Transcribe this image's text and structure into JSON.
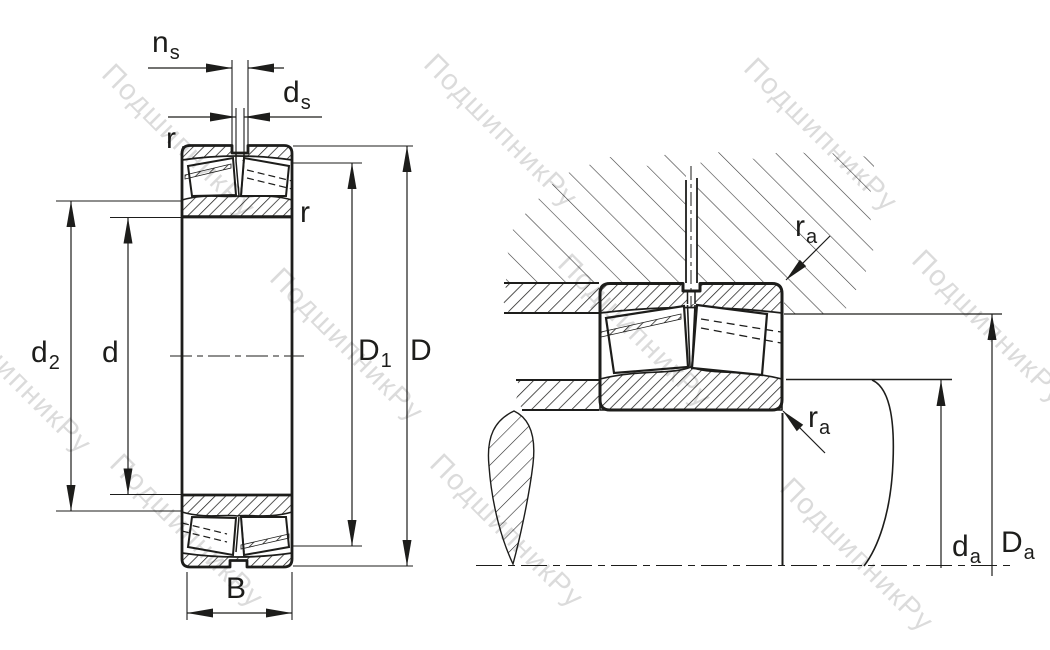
{
  "watermark": {
    "text": "ПодшипникРу"
  },
  "labels": {
    "ns": {
      "main": "n",
      "sub": "s"
    },
    "ds": {
      "main": "d",
      "sub": "s"
    },
    "r_top": {
      "main": "r",
      "sub": ""
    },
    "r_right": {
      "main": "r",
      "sub": ""
    },
    "d2": {
      "main": "d",
      "sub": "2"
    },
    "d": {
      "main": "d",
      "sub": ""
    },
    "D1": {
      "main": "D",
      "sub": "1"
    },
    "D": {
      "main": "D",
      "sub": ""
    },
    "B": {
      "main": "B",
      "sub": ""
    },
    "ra_top": {
      "main": "r",
      "sub": "a"
    },
    "ra_bot": {
      "main": "r",
      "sub": "a"
    },
    "da": {
      "main": "d",
      "sub": "a"
    },
    "Da": {
      "main": "D",
      "sub": "a"
    }
  },
  "drawing": {
    "type": "spherical-roller-bearing-cross-section",
    "views": [
      "bearing section with dimensions",
      "bearing mounted in housing on shaft"
    ],
    "dimension_marks": [
      "ns",
      "ds",
      "r",
      "r",
      "d2",
      "d",
      "D1",
      "D",
      "B",
      "ra",
      "ra",
      "da",
      "Da"
    ],
    "line_color": "#1d1d1b"
  }
}
